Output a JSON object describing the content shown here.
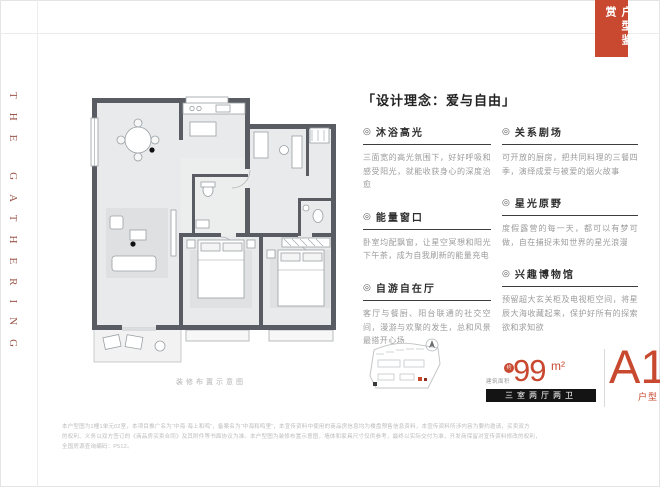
{
  "colors": {
    "accent": "#C8492F",
    "brand_letters": "#9C554A",
    "wall": "#595D63",
    "bar_bg": "#141414"
  },
  "brand": {
    "vertical_text": "THE GATHERING"
  },
  "banner": {
    "title": "户型鉴赏",
    "side_text": "THE GATHERING"
  },
  "floor_plan": {
    "caption": "装修布置示意图"
  },
  "design": {
    "title": "「设计理念：爱与自由」",
    "bullet_glyph": "◎",
    "columns": {
      "left": [
        {
          "heading": "沐浴高光",
          "body": "三面宽的高光氛围下，好好呼吸和感受阳光，就能收获身心的深度治愈"
        },
        {
          "heading": "能量窗口",
          "body": "卧室均配飘窗，让星空冥想和阳光下午茶，成为自我刷新的能量充电"
        },
        {
          "heading": "自游自在厅",
          "body": "客厅与餐厨、阳台联通的社交空间，漫游与欢聚的发生，总和风景最搭开心场"
        }
      ],
      "right": [
        {
          "heading": "关系剧场",
          "body": "可开放的厨房，把共同料理的三餐四季，演绎成爱与被爱的烟火故事"
        },
        {
          "heading": "星光原野",
          "body": "度假露营的每一天，都可以有梦可做，自在捕捉未知世界的星光浪漫"
        },
        {
          "heading": "兴趣博物馆",
          "body": "预留超大玄关柜及电视柜空间，将星辰大海收藏起来，保护好所有的探索欲和求知欲"
        }
      ]
    }
  },
  "unit": {
    "area_label": "建筑面积",
    "approx_badge": "约",
    "area_value": "99",
    "area_unit": "m²",
    "layout_tag": "三室两厅两卫",
    "name": "A1",
    "name_suffix": "户型"
  },
  "disclaimer": {
    "lines": [
      "本户型图为1幢1单元02室，本项目推广名为“中海·海上和鸣”，备案名为“中海和鸣里”，本宣传资料中使用的商品房信息均为楼盘预售信息资料，本宣传资料所涉内容为要约邀请，买卖双方",
      "的权利、义务以双方签订的《商品房买卖合同》及其附件等书面协议为准。本户型图为装修布置示意图，墙体和家具尺寸仅供参考，最终以实际交付为准，开发商保留对宣传资料修改的权利，",
      "全国房源查询编码：P512。"
    ]
  }
}
